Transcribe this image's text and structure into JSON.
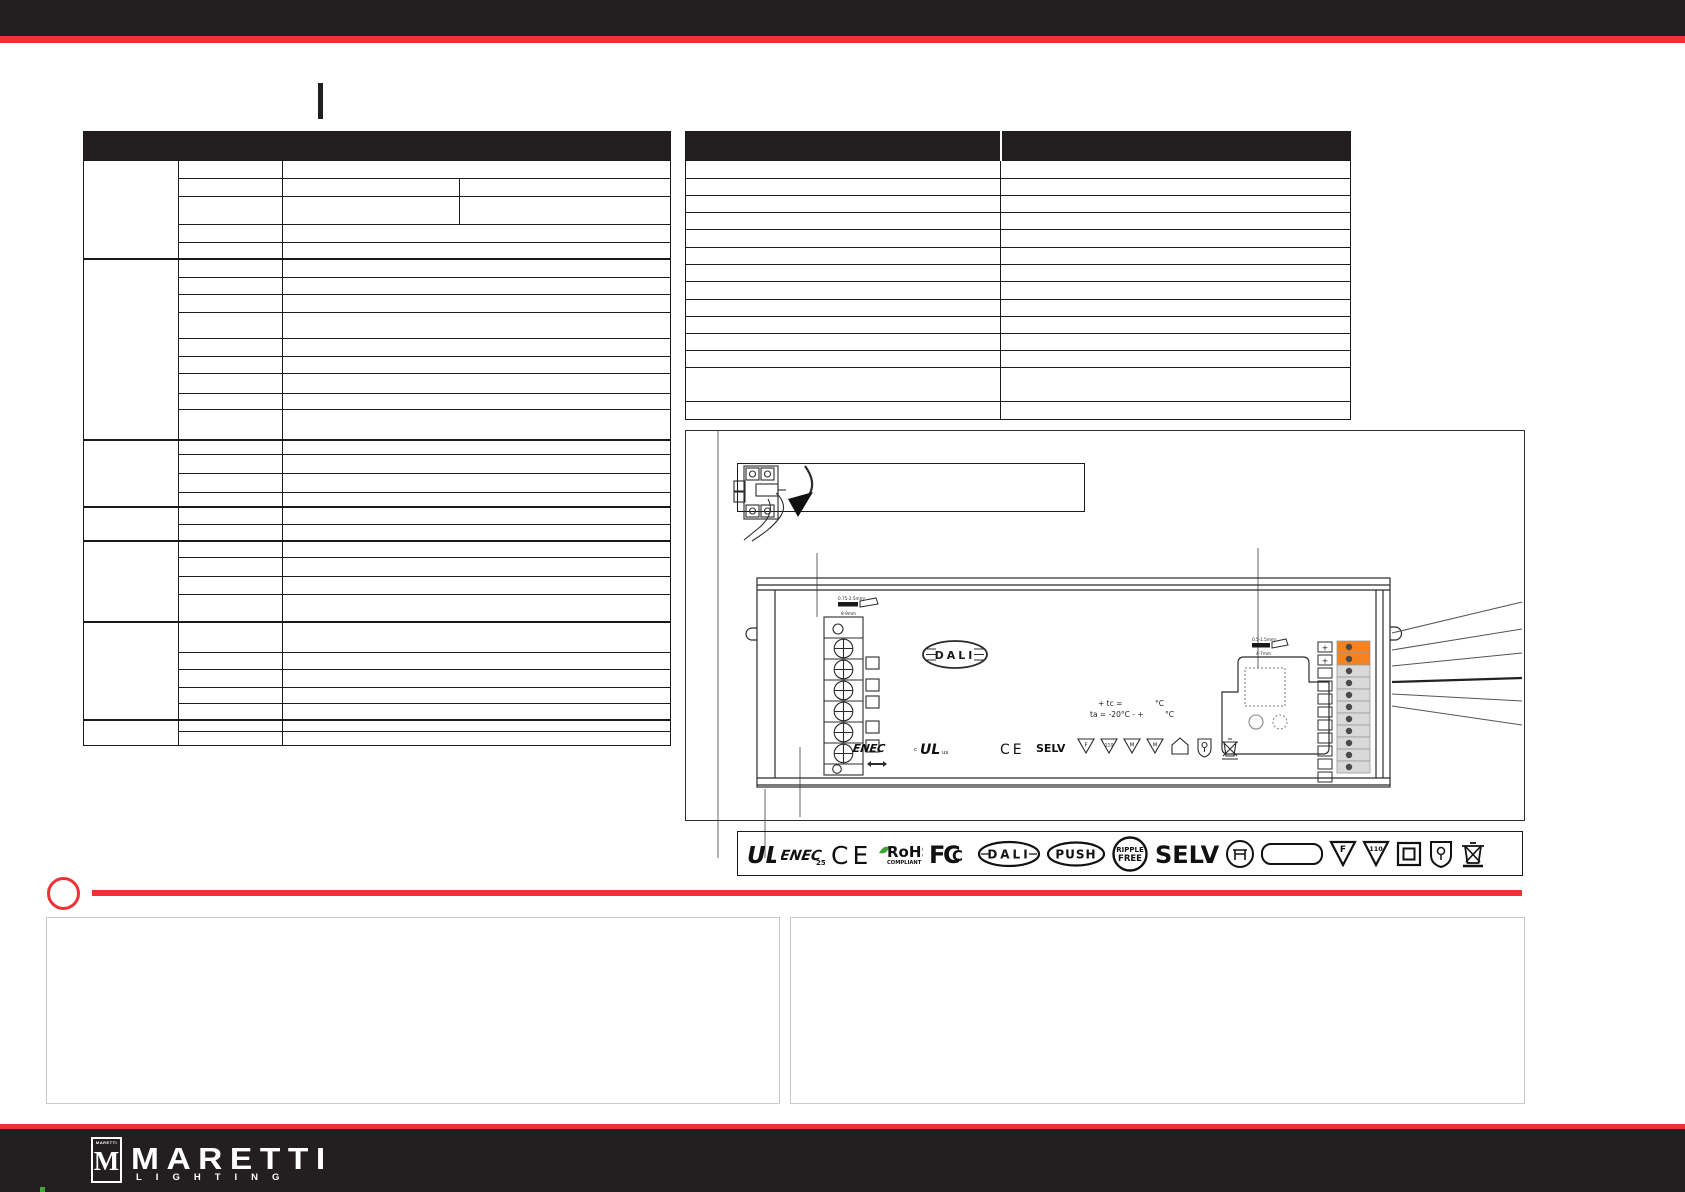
{
  "colors": {
    "bar_black": "#231F20",
    "accent_red": "#EC3237",
    "terminal_orange": "#F58220",
    "rohs_green": "#3FA535",
    "table_border": "#1A1A1A"
  },
  "device": {
    "dali": "DALI",
    "strip_left": {
      "line1": "0.75-2.5mm²",
      "line2": "8-9mm"
    },
    "strip_right": {
      "line1": "0.5-1.5mm²",
      "line2": "4-7mm"
    },
    "tc_line1_label": "+ tc =",
    "tc_line1_unit": "°C",
    "tc_line2_label": "ta = -20°C - +",
    "tc_line2_unit": "°C",
    "marks": {
      "ul_c": "c",
      "ul": "UL",
      "ul_us": "us",
      "enec": "ENEC",
      "ce": "CE",
      "selv": "SELV",
      "tri": [
        "F",
        "110",
        "M",
        "M"
      ]
    },
    "plus_top": "+",
    "plus_bottom": "+"
  },
  "logos": {
    "ul": "UL",
    "enec": "ENEC",
    "enec_n": "25",
    "ce": "CE",
    "rohs": "RoHS",
    "rohs_sub": "COMPLIANT",
    "fcc_f": "F",
    "fcc_c": "C",
    "fcc_c2": "C",
    "dali": "DALI",
    "push": "PUSH",
    "ripple_1": "RIPPLE",
    "ripple_2": "FREE",
    "selv": "SELV",
    "tri_f": "F",
    "tri_n": "110"
  },
  "footer": {
    "emblem_word": "MARETTI",
    "emblem_m": "M",
    "brand": "MARETTI",
    "tagline": "LIGHTING"
  }
}
